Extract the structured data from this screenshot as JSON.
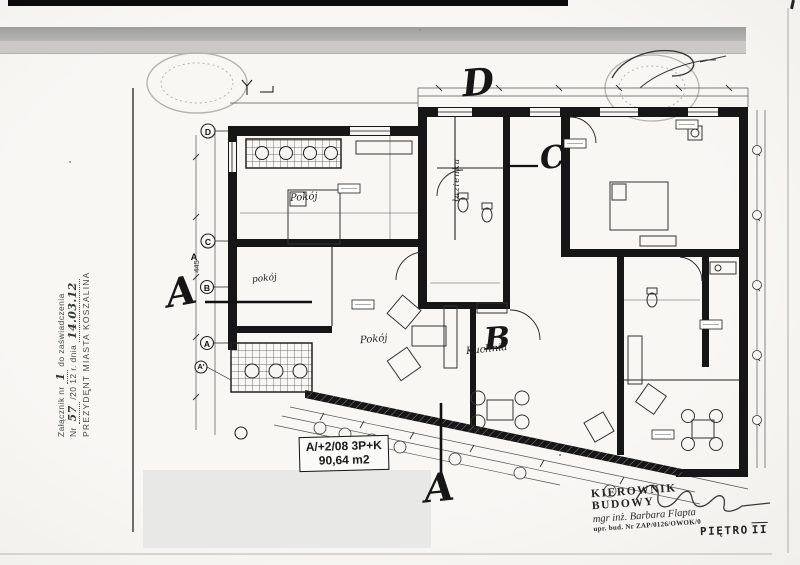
{
  "document": {
    "attachment_stamp": {
      "line1_label": "Załącznik nr",
      "line1_value": "1",
      "line1_suffix": "do zaświadczenia",
      "line2_label": "Nr",
      "line2_value": "57",
      "line2_mid": "/20 12 r. dnia",
      "line2_date": "14.03.12",
      "line3": "PREZYDENT MIASTA KOSZALINA"
    },
    "apartment_label": {
      "code": "A/+2/08 3P+K",
      "area": "90,64 m2"
    },
    "signature_block": {
      "title": "KIEROWNIK BUDOWY",
      "name": "mgr inż. Barbara Flapta",
      "license": "upr. bud. Nr ZAP/0126/OWOK/0",
      "floor_word": "PIĘTRO",
      "floor_roman": "II"
    }
  },
  "plan": {
    "handwritten_letters": {
      "d": "D",
      "c": "C",
      "b": "B",
      "a_side": "A",
      "a_bottom": "A"
    },
    "grid_markers": {
      "d": "D",
      "c": "C",
      "b": "B",
      "a": "A",
      "a_prime": "A'",
      "a_section": "A"
    },
    "room_labels": {
      "room_top_left": "Pokój",
      "room_mid_left": "pokój",
      "living_room": "Pokój",
      "kitchen": "Kuchnia",
      "bathroom": "łazienka"
    },
    "dimensions": {
      "left_vertical": "445"
    },
    "colors": {
      "ink": "#161616",
      "stamp_gray": "#b3b6ae",
      "paper": "#f6f5f2"
    }
  }
}
